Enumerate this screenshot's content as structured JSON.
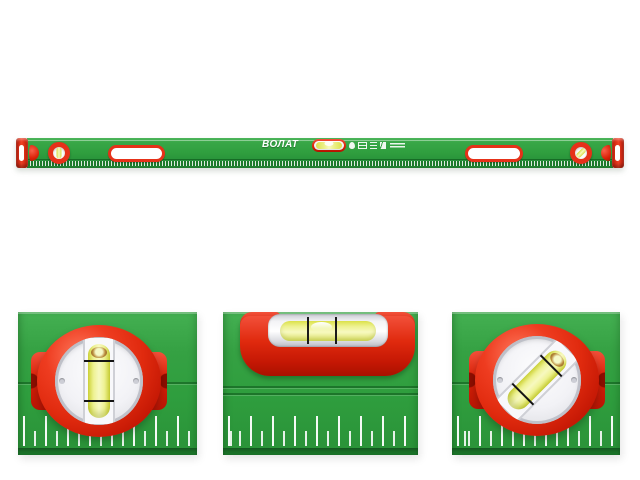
{
  "colors": {
    "background": "#ffffff",
    "body_green": "#2f9e3e",
    "body_green_dark": "#1f7c2e",
    "ruler_green": "#1c7a2b",
    "cap_red": "#e63119",
    "cap_red_dark": "#a81300",
    "vial_yellow": "#e9ee62",
    "vial_yellow_light": "#f7f9c0",
    "glass_white": "#f2f2f6",
    "silver": "#c9cad2",
    "tick_white": "#ffffff"
  },
  "level_bar": {
    "brand": "ВОЛАТ",
    "icons": [
      {
        "name": "hand-pictogram-icon"
      },
      {
        "name": "level-spec-pictogram-icon"
      },
      {
        "name": "lines-pictogram-icon"
      },
      {
        "name": "arrow-pictogram-icon"
      },
      {
        "name": "fine-print-lines"
      }
    ]
  },
  "detail_views": [
    {
      "name": "vertical-round-vial-closeup"
    },
    {
      "name": "horizontal-vial-closeup"
    },
    {
      "name": "angled-round-vial-closeup"
    }
  ]
}
